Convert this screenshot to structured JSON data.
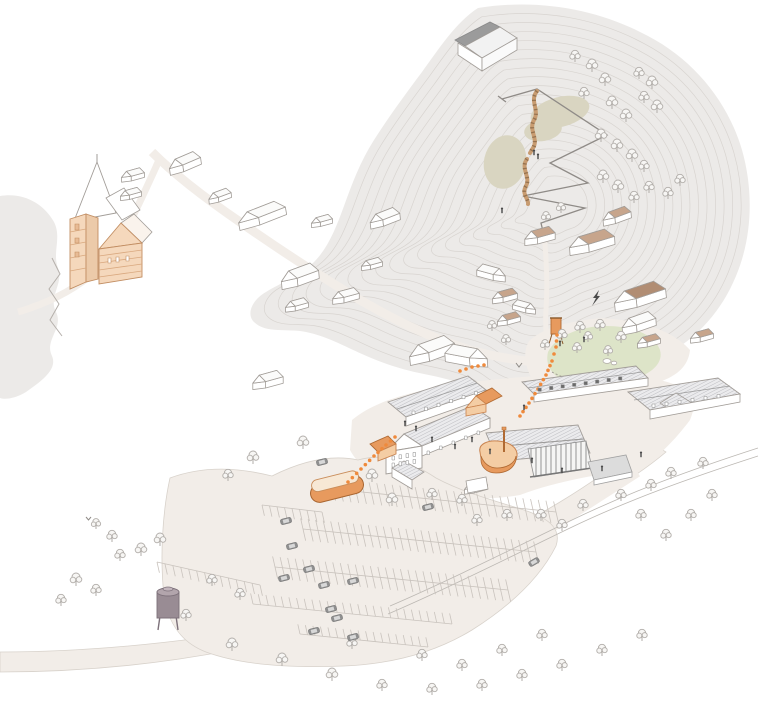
{
  "palette": {
    "paper": "#ffffff",
    "hill": "#eceae8",
    "contour": "#d8d4d0",
    "road": "#f2ede8",
    "roadEdge": "#d8d2cb",
    "outline": "#a29d98",
    "wallWhite": "#ffffff",
    "roofBase": "#ebebed",
    "hatchLine": "#a9a9af",
    "roofTan": "#c7a58c",
    "roofTanLight": "#dcc3ae",
    "roofTanDark": "#b18d73",
    "wallPeach": "#f5d8bc",
    "peachSide": "#eccaa9",
    "peachStripe": "#d9a87f",
    "peachOutline": "#c28e63",
    "orange": "#e79a5e",
    "orangeLight": "#f4cda4",
    "dots": "#ef8a3c",
    "slide": "#c89c71",
    "slideRung": "#8d6b4a",
    "olive": "#d9d5c1",
    "lawn": "#dde4c8",
    "treeStroke": "#b2aeaa",
    "treeFill": "#f7f6f4",
    "carBody": "#8f8f8f",
    "carGlass": "#d8d8d8",
    "silo": "#998c94",
    "pathGray": "#8f8b87",
    "rail": "#bcb8b3",
    "person": "#4a4a4a",
    "windowDark": "#6b6b6b",
    "grayRoof": "#9b9b9b",
    "stall": "#c9c3bd"
  },
  "scene": {
    "contours": {
      "count": 20,
      "shrinkStep": 0.045,
      "cx": 560,
      "cy": 205
    },
    "houses": [
      {
        "x": 185,
        "y": 163,
        "s": 0.85,
        "r": -8,
        "f": false,
        "w": 1,
        "t": "white"
      },
      {
        "x": 133,
        "y": 175,
        "s": 0.6,
        "r": 0,
        "f": false,
        "w": 1,
        "t": "white"
      },
      {
        "x": 131,
        "y": 194,
        "s": 0.55,
        "r": 0,
        "f": false,
        "w": 1,
        "t": "white"
      },
      {
        "x": 220,
        "y": 196,
        "s": 0.6,
        "r": -5,
        "f": false,
        "w": 1,
        "t": "white"
      },
      {
        "x": 262,
        "y": 215,
        "s": 0.95,
        "r": -10,
        "f": false,
        "w": 1.35,
        "t": "white"
      },
      {
        "x": 322,
        "y": 221,
        "s": 0.55,
        "r": 0,
        "f": false,
        "w": 1,
        "t": "white"
      },
      {
        "x": 385,
        "y": 218,
        "s": 0.8,
        "r": -6,
        "f": false,
        "w": 1,
        "t": "white"
      },
      {
        "x": 372,
        "y": 264,
        "s": 0.55,
        "r": 0,
        "f": false,
        "w": 1,
        "t": "white"
      },
      {
        "x": 300,
        "y": 276,
        "s": 1.0,
        "r": -5,
        "f": false,
        "w": 1,
        "t": "white"
      },
      {
        "x": 346,
        "y": 296,
        "s": 0.7,
        "r": 0,
        "f": false,
        "w": 1,
        "t": "white"
      },
      {
        "x": 297,
        "y": 305,
        "s": 0.6,
        "r": 0,
        "f": false,
        "w": 1,
        "t": "white"
      },
      {
        "x": 268,
        "y": 380,
        "s": 0.8,
        "r": 0,
        "f": false,
        "w": 1,
        "t": "white"
      },
      {
        "x": 432,
        "y": 350,
        "s": 1.1,
        "r": -6,
        "f": false,
        "w": 1.1,
        "t": "white"
      },
      {
        "x": 466,
        "y": 356,
        "s": 1.05,
        "r": -4,
        "f": true,
        "w": 1.05,
        "t": "white"
      },
      {
        "x": 491,
        "y": 273,
        "s": 0.75,
        "r": 0,
        "f": true,
        "w": 1,
        "t": "white"
      },
      {
        "x": 505,
        "y": 296,
        "s": 0.65,
        "r": 0,
        "f": false,
        "w": 1,
        "t": "tan"
      },
      {
        "x": 509,
        "y": 319,
        "s": 0.6,
        "r": 0,
        "f": false,
        "w": 1,
        "t": "tan"
      },
      {
        "x": 524,
        "y": 307,
        "s": 0.6,
        "r": 0,
        "f": true,
        "w": 1,
        "t": "white"
      },
      {
        "x": 617,
        "y": 216,
        "s": 0.75,
        "r": -5,
        "f": false,
        "w": 1,
        "t": "tan"
      },
      {
        "x": 540,
        "y": 236,
        "s": 0.8,
        "r": 0,
        "f": false,
        "w": 1,
        "t": "tan"
      },
      {
        "x": 592,
        "y": 242,
        "s": 1.0,
        "r": -4,
        "f": false,
        "w": 1.2,
        "t": "tan"
      },
      {
        "x": 640,
        "y": 296,
        "s": 1.1,
        "r": -6,
        "f": false,
        "w": 1.25,
        "t": "tanDark"
      },
      {
        "x": 639,
        "y": 323,
        "s": 0.9,
        "r": -4,
        "f": false,
        "w": 1,
        "t": "white"
      },
      {
        "x": 649,
        "y": 341,
        "s": 0.6,
        "r": 0,
        "f": false,
        "w": 1,
        "t": "tan"
      },
      {
        "x": 702,
        "y": 336,
        "s": 0.6,
        "r": 0,
        "f": false,
        "w": 1,
        "t": "tan"
      },
      {
        "x": 476,
        "y": 487,
        "s": 0.6,
        "r": 0,
        "f": false,
        "w": 1,
        "t": "white"
      }
    ],
    "trees": [
      [
        575,
        62,
        0.9
      ],
      [
        592,
        72,
        1.0
      ],
      [
        605,
        86,
        1.0
      ],
      [
        584,
        99,
        0.9
      ],
      [
        612,
        109,
        1.0
      ],
      [
        626,
        122,
        1.0
      ],
      [
        639,
        79,
        0.9
      ],
      [
        652,
        89,
        1.0
      ],
      [
        644,
        103,
        0.9
      ],
      [
        657,
        113,
        1.0
      ],
      [
        601,
        142,
        1.0
      ],
      [
        617,
        152,
        1.0
      ],
      [
        632,
        162,
        1.0
      ],
      [
        644,
        172,
        0.9
      ],
      [
        603,
        183,
        1.0
      ],
      [
        618,
        193,
        1.0
      ],
      [
        634,
        203,
        0.9
      ],
      [
        649,
        193,
        0.9
      ],
      [
        561,
        213,
        0.8
      ],
      [
        546,
        222,
        0.8
      ],
      [
        668,
        199,
        0.9
      ],
      [
        680,
        186,
        0.9
      ],
      [
        506,
        345,
        0.8
      ],
      [
        492,
        331,
        0.8
      ],
      [
        545,
        350,
        0.8
      ],
      [
        562,
        341,
        0.9
      ],
      [
        580,
        333,
        0.9
      ],
      [
        600,
        331,
        0.9
      ],
      [
        621,
        343,
        0.9
      ],
      [
        577,
        353,
        0.8
      ],
      [
        608,
        356,
        0.8
      ],
      [
        588,
        342,
        0.8
      ],
      [
        303,
        449,
        1.0
      ],
      [
        253,
        464,
        1.0
      ],
      [
        228,
        481,
        0.9
      ],
      [
        372,
        482,
        1.0
      ],
      [
        432,
        500,
        0.9
      ],
      [
        462,
        506,
        0.9
      ],
      [
        392,
        506,
        1.0
      ],
      [
        477,
        526,
        0.9
      ],
      [
        507,
        521,
        0.9
      ],
      [
        541,
        521,
        0.9
      ],
      [
        562,
        531,
        0.9
      ],
      [
        583,
        511,
        0.9
      ],
      [
        621,
        501,
        0.9
      ],
      [
        651,
        491,
        0.9
      ],
      [
        671,
        479,
        0.9
      ],
      [
        703,
        469,
        0.9
      ],
      [
        641,
        521,
        0.9
      ],
      [
        666,
        541,
        0.9
      ],
      [
        691,
        521,
        0.9
      ],
      [
        712,
        501,
        0.9
      ],
      [
        160,
        546,
        1.0
      ],
      [
        141,
        556,
        1.0
      ],
      [
        120,
        561,
        0.9
      ],
      [
        76,
        586,
        1.0
      ],
      [
        96,
        596,
        0.9
      ],
      [
        61,
        606,
        0.9
      ],
      [
        186,
        621,
        0.9
      ],
      [
        232,
        651,
        1.0
      ],
      [
        282,
        666,
        1.0
      ],
      [
        332,
        681,
        1.0
      ],
      [
        382,
        691,
        0.9
      ],
      [
        432,
        695,
        0.9
      ],
      [
        482,
        691,
        0.9
      ],
      [
        522,
        681,
        0.9
      ],
      [
        562,
        671,
        0.9
      ],
      [
        602,
        656,
        0.9
      ],
      [
        642,
        641,
        0.9
      ],
      [
        542,
        641,
        0.9
      ],
      [
        502,
        656,
        0.9
      ],
      [
        462,
        671,
        0.9
      ],
      [
        422,
        661,
        0.9
      ],
      [
        352,
        649,
        0.9
      ],
      [
        240,
        600,
        0.9
      ],
      [
        212,
        586,
        0.9
      ],
      [
        112,
        542,
        0.9
      ],
      [
        96,
        529,
        0.8
      ]
    ],
    "cars": [
      [
        322,
        462,
        -14
      ],
      [
        286,
        521,
        -14
      ],
      [
        292,
        546,
        -14
      ],
      [
        309,
        569,
        -14
      ],
      [
        284,
        578,
        -14
      ],
      [
        324,
        585,
        -14
      ],
      [
        353,
        581,
        -14
      ],
      [
        331,
        609,
        -14
      ],
      [
        337,
        618,
        -14
      ],
      [
        314,
        631,
        -14
      ],
      [
        353,
        637,
        -14
      ],
      [
        534,
        562,
        -30
      ],
      [
        428,
        507,
        -14
      ]
    ],
    "people": [
      [
        405,
        425
      ],
      [
        432,
        441
      ],
      [
        455,
        448
      ],
      [
        472,
        441
      ],
      [
        490,
        453
      ],
      [
        532,
        462
      ],
      [
        562,
        472
      ],
      [
        602,
        470
      ],
      [
        641,
        456
      ],
      [
        524,
        409
      ],
      [
        560,
        345
      ],
      [
        584,
        341
      ],
      [
        534,
        154
      ],
      [
        538,
        158
      ],
      [
        502,
        212
      ],
      [
        416,
        430
      ]
    ],
    "routeDots": {
      "spacing": 6,
      "segments": [
        [
          [
            348,
            482
          ],
          [
            361,
            469
          ],
          [
            374,
            456
          ],
          [
            386,
            445
          ],
          [
            395,
            437
          ]
        ],
        [
          [
            520,
            416
          ],
          [
            529,
            403
          ],
          [
            538,
            389
          ],
          [
            546,
            375
          ],
          [
            552,
            361
          ],
          [
            556,
            347
          ],
          [
            557,
            335
          ]
        ],
        [
          [
            460,
            371
          ],
          [
            472,
            367
          ],
          [
            484,
            365
          ]
        ]
      ]
    },
    "parkingBanks": [
      {
        "x1": 262,
        "y1": 505,
        "x2": 322,
        "y2": 512,
        "len": 11,
        "gap": 7,
        "side": "down"
      },
      {
        "x1": 333,
        "y1": 489,
        "x2": 556,
        "y2": 512,
        "len": 12,
        "gap": 7.5,
        "side": "both"
      },
      {
        "x1": 303,
        "y1": 529,
        "x2": 536,
        "y2": 552,
        "len": 12,
        "gap": 7.5,
        "side": "both"
      },
      {
        "x1": 275,
        "y1": 567,
        "x2": 508,
        "y2": 590,
        "len": 12,
        "gap": 7.5,
        "side": "both"
      },
      {
        "x1": 253,
        "y1": 604,
        "x2": 452,
        "y2": 624,
        "len": 12,
        "gap": 7.5,
        "side": "up"
      },
      {
        "x1": 157,
        "y1": 562,
        "x2": 260,
        "y2": 585,
        "len": 11,
        "gap": 8,
        "side": "down"
      },
      {
        "x1": 300,
        "y1": 634,
        "x2": 428,
        "y2": 647,
        "len": 11,
        "gap": 7.5,
        "side": "up"
      }
    ],
    "windows": [
      {
        "x": 392,
        "y": 456,
        "n": 4,
        "dx": 7,
        "dy": -1.2,
        "w": 2.6,
        "h": 4,
        "dark": false
      },
      {
        "x": 392,
        "y": 463,
        "n": 4,
        "dx": 7,
        "dy": -1.2,
        "w": 2.6,
        "h": 4,
        "dark": false
      },
      {
        "x": 427,
        "y": 451,
        "n": 5,
        "dx": 12.5,
        "dy": -5,
        "w": 2.6,
        "h": 3.6,
        "dark": false
      },
      {
        "x": 412,
        "y": 411,
        "n": 6,
        "dx": 12.5,
        "dy": -3.9,
        "w": 3,
        "h": 3.4,
        "dark": false
      },
      {
        "x": 538,
        "y": 388,
        "n": 8,
        "dx": 11.5,
        "dy": -1.6,
        "w": 3.4,
        "h": 3.2,
        "dark": true
      },
      {
        "x": 652,
        "y": 404,
        "n": 6,
        "dx": 13,
        "dy": -1.9,
        "w": 3,
        "h": 3.4,
        "dark": false
      }
    ]
  }
}
